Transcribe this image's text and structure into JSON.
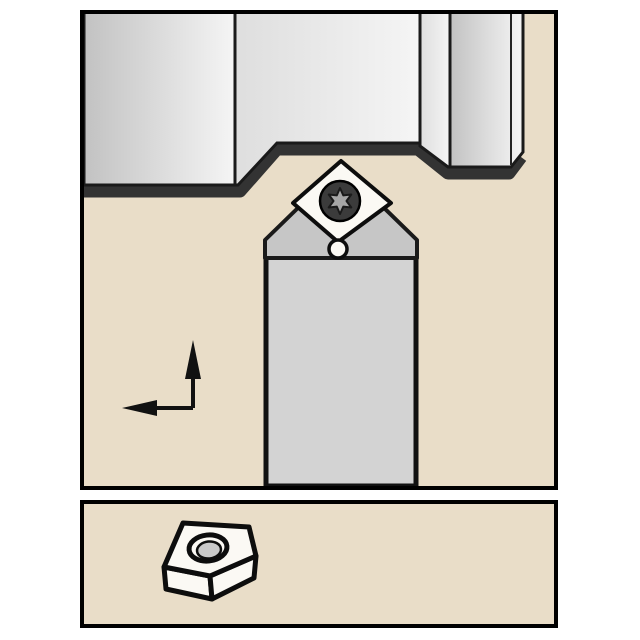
{
  "canvas": {
    "width": 640,
    "height": 640
  },
  "colors": {
    "page_bg": "#ffffff",
    "panel_bg": "#e9ddc8",
    "panel_border": "#000000",
    "outline": "#111111",
    "workpiece_band": "#333333",
    "workpiece_face_dark": "#c2c2c2",
    "workpiece_face_mid": "#dedede",
    "workpiece_face_light": "#f5f5f5",
    "holder_head": "#c6c6c6",
    "holder_shank": "#d3d3d3",
    "insert_face": "#fbf9f4",
    "screw_body": "#3b3b3b",
    "screw_star": "#a6a6a6",
    "hole_bore": "#c9c9c9",
    "arrow": "#111111"
  },
  "icons": {
    "feed_direction_arrows": "L-shaped indicator: arrow up + arrow left",
    "clamp_screw": "torx screw head",
    "insert_tip_radius": "small circle at insert nose",
    "insert_3d": "rhombic indexable insert with center hole, isometric view"
  }
}
